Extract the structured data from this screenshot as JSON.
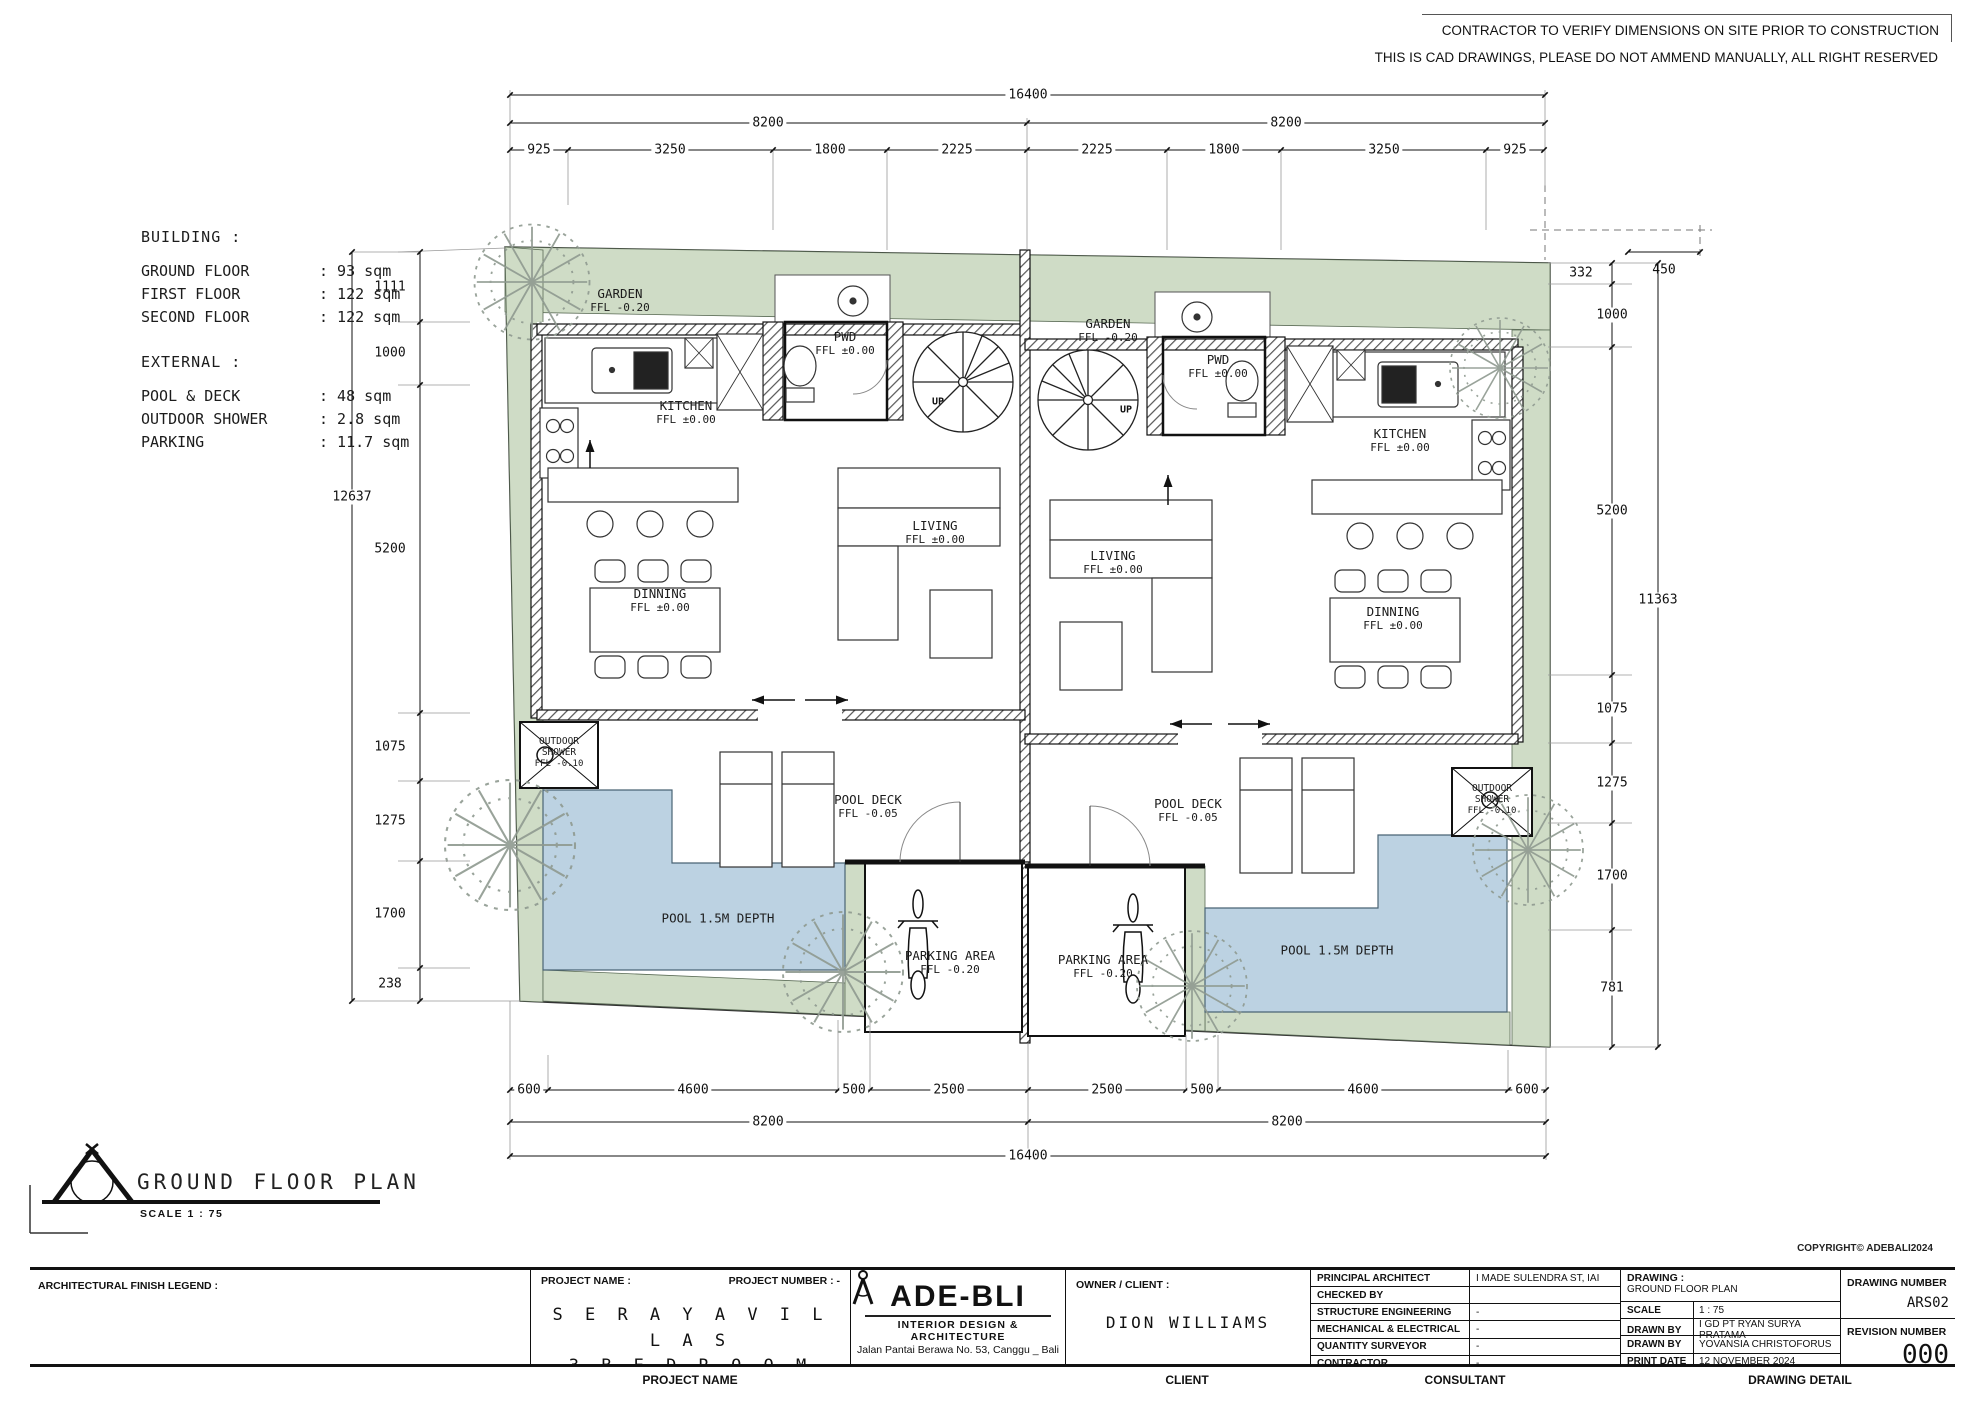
{
  "disclaimer": {
    "line1": "CONTRACTOR TO VERIFY DIMENSIONS ON SITE PRIOR TO CONSTRUCTION",
    "line2": "THIS IS CAD DRAWINGS, PLEASE DO NOT AMMEND MANUALLY, ALL RIGHT RESERVED"
  },
  "copyright": "COPYRIGHT© ADEBALI2024",
  "info": {
    "building_title": "BUILDING :",
    "building_rows": [
      {
        "label": "GROUND FLOOR",
        "value": ": 93 sqm"
      },
      {
        "label": "FIRST FLOOR",
        "value": ": 122 sqm"
      },
      {
        "label": "SECOND FLOOR",
        "value": ": 122 sqm"
      }
    ],
    "external_title": "EXTERNAL :",
    "external_rows": [
      {
        "label": "POOL & DECK",
        "value": ": 48 sqm"
      },
      {
        "label": "OUTDOOR SHOWER",
        "value": ": 2.8 sqm"
      },
      {
        "label": "PARKING",
        "value": ": 11.7 sqm"
      }
    ]
  },
  "dims": {
    "top_total": "16400",
    "top_half_left": "8200",
    "top_half_right": "8200",
    "top_sub": [
      "925",
      "3250",
      "1800",
      "2225",
      "2225",
      "1800",
      "3250",
      "925"
    ],
    "left_chain": [
      "1111",
      "1000",
      "5200",
      "1075",
      "1275",
      "1700",
      "238"
    ],
    "left_total": "12637",
    "right_offsets": [
      "332",
      "450"
    ],
    "right_chain": [
      "1000",
      "5200",
      "1075",
      "1275",
      "1700",
      "781"
    ],
    "right_total": "11363",
    "bottom_sub": [
      "600",
      "4600",
      "500",
      "2500",
      "2500",
      "500",
      "4600",
      "600"
    ],
    "bottom_half_left": "8200",
    "bottom_half_right": "8200",
    "bottom_total": "16400"
  },
  "plan": {
    "villa_left": {
      "garden_name": "GARDEN",
      "garden_ffl": "FFL -0.20",
      "kitchen_name": "KITCHEN",
      "kitchen_ffl": "FFL ±0.00",
      "pwd_name": "PWD",
      "pwd_ffl": "FFL ±0.00",
      "living_name": "LIVING",
      "living_ffl": "FFL ±0.00",
      "dinning_name": "DINNING",
      "dinning_ffl": "FFL ±0.00",
      "shower_name": "OUTDOOR SHOWER",
      "shower_ffl": "FFL -0.10",
      "deck_name": "POOL DECK",
      "deck_ffl": "FFL -0.05",
      "pool_label": "POOL 1.5M DEPTH",
      "parking_name": "PARKING AREA",
      "parking_ffl": "FFL -0.20",
      "up": "UP"
    },
    "villa_right": {
      "garden_name": "GARDEN",
      "garden_ffl": "FFL -0.20",
      "kitchen_name": "KITCHEN",
      "kitchen_ffl": "FFL ±0.00",
      "pwd_name": "PWD",
      "pwd_ffl": "FFL ±0.00",
      "living_name": "LIVING",
      "living_ffl": "FFL ±0.00",
      "dinning_name": "DINNING",
      "dinning_ffl": "FFL ±0.00",
      "shower_name": "OUTDOOR SHOWER",
      "shower_ffl": "FFL -0.10",
      "deck_name": "POOL DECK",
      "deck_ffl": "FFL -0.05",
      "pool_label": "POOL 1.5M DEPTH",
      "parking_name": "PARKING AREA",
      "parking_ffl": "FFL -0.20",
      "up": "UP"
    }
  },
  "title": {
    "text": "GROUND FLOOR PLAN",
    "scale": "SCALE 1 : 75"
  },
  "footer": {
    "legend_label": "ARCHITECTURAL FINISH LEGEND :",
    "project_name_label": "PROJECT NAME :",
    "project_number_label": "PROJECT NUMBER : -",
    "project_name_line1": "S E R A Y A   V I L L A S",
    "project_name_line2": "3   B E D R O O M",
    "logo_left": "ADE-B",
    "logo_right": "LI",
    "logo_tagline": "INTERIOR  DESIGN & ARCHITECTURE",
    "logo_address": "Jalan Pantai Berawa No. 53, Canggu _ Bali",
    "owner_label": "OWNER / CLIENT :",
    "owner_value": "DION WILLIAMS",
    "consultant_rows": [
      {
        "label": "PRINCIPAL ARCHITECT",
        "value": "I MADE SULENDRA ST, IAI"
      },
      {
        "label": "CHECKED BY",
        "value": "MS"
      },
      {
        "label": "STRUCTURE ENGINEERING",
        "value": "-"
      },
      {
        "label": "MECHANICAL & ELECTRICAL",
        "value": "-"
      },
      {
        "label": "QUANTITY SURVEYOR",
        "value": "-"
      },
      {
        "label": "CONTRACTOR",
        "value": "-"
      }
    ],
    "drawing_label": "DRAWING :",
    "drawing_value": "GROUND FLOOR PLAN",
    "detail_rows": [
      {
        "label": "SCALE",
        "value": "1 : 75"
      },
      {
        "label": "DRAWN BY",
        "value": "I GD PT RYAN SURYA PRATAMA"
      },
      {
        "label": "DRAWN BY",
        "value": "YOVANSIA CHRISTOFORUS"
      },
      {
        "label": "PRINT DATE",
        "value": "12 NOVEMBER 2024"
      }
    ],
    "drawing_number_label": "DRAWING NUMBER",
    "drawing_number": "ARS02",
    "revision_label": "REVISION NUMBER",
    "revision": "000",
    "bottom_labels": [
      "PROJECT NAME",
      "CLIENT",
      "CONSULTANT",
      "DRAWING DETAIL"
    ]
  }
}
